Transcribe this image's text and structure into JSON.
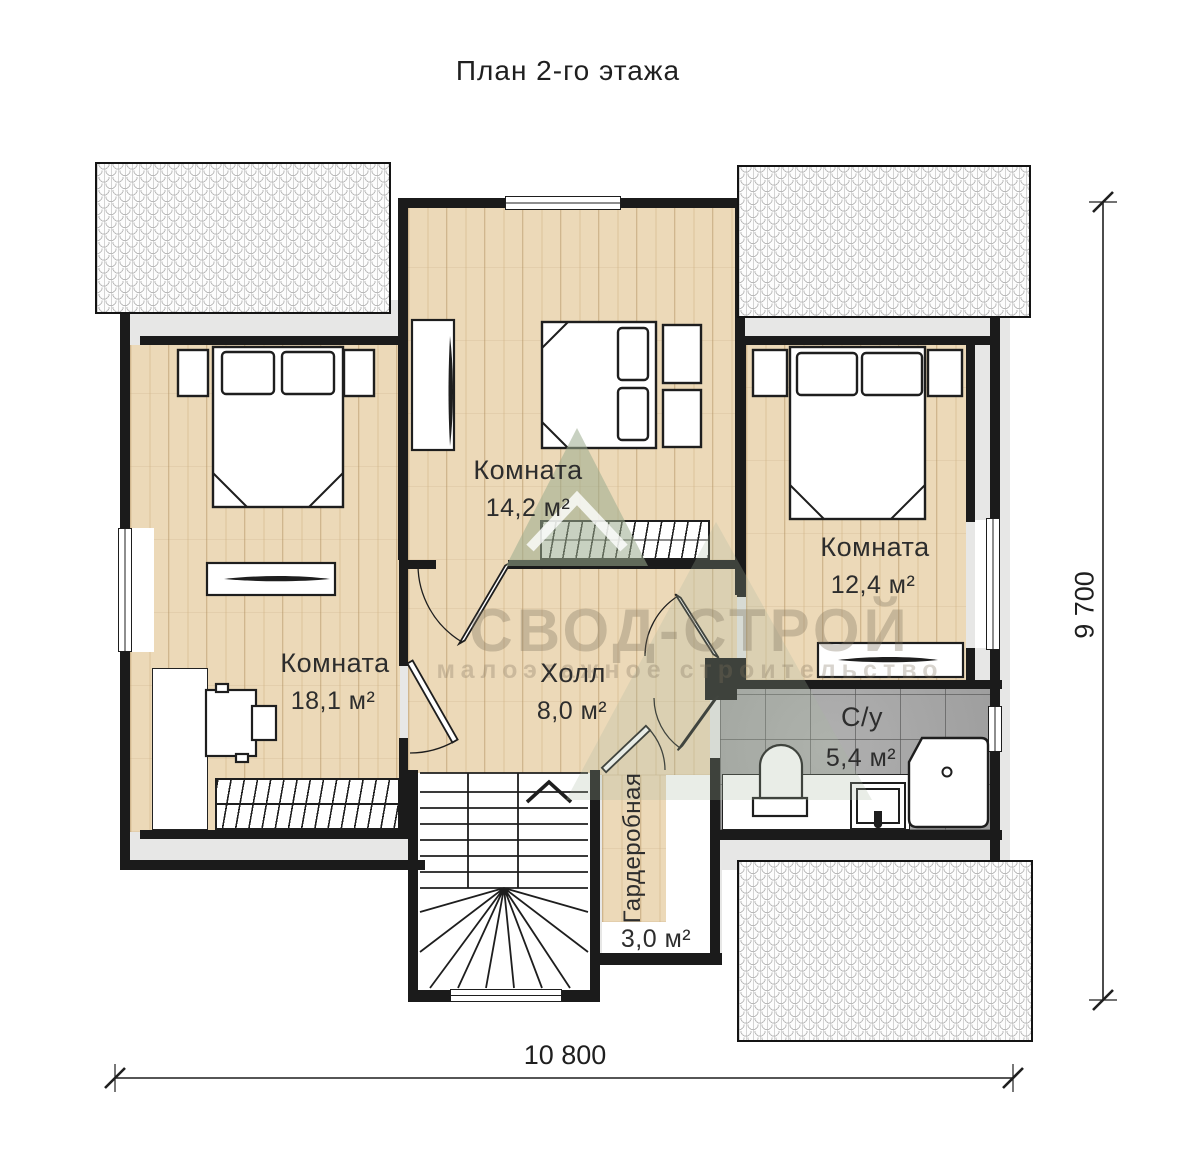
{
  "title": "План 2-го этажа",
  "rooms": [
    {
      "name": "Комната",
      "area": "14,2 м²"
    },
    {
      "name": "Комната",
      "area": "12,4 м²"
    },
    {
      "name": "Комната",
      "area": "18,1 м²"
    },
    {
      "name": "Холл",
      "area": "8,0 м²"
    },
    {
      "name": "С/у",
      "area": "5,4 м²"
    },
    {
      "name": "Гардеробная",
      "area": "3,0 м²"
    }
  ],
  "dimensions": {
    "width": "10 800",
    "height": "9 700"
  },
  "watermark": {
    "brand": "СВОД-СТРОЙ",
    "tagline": "малоэтажное строительство"
  },
  "colors": {
    "wall": "#1b1b1b",
    "wood": "#ecd9b8",
    "tile": "#a7a7a7",
    "attic": "#e7e7e6",
    "logo_green": "#a9b9a2"
  }
}
